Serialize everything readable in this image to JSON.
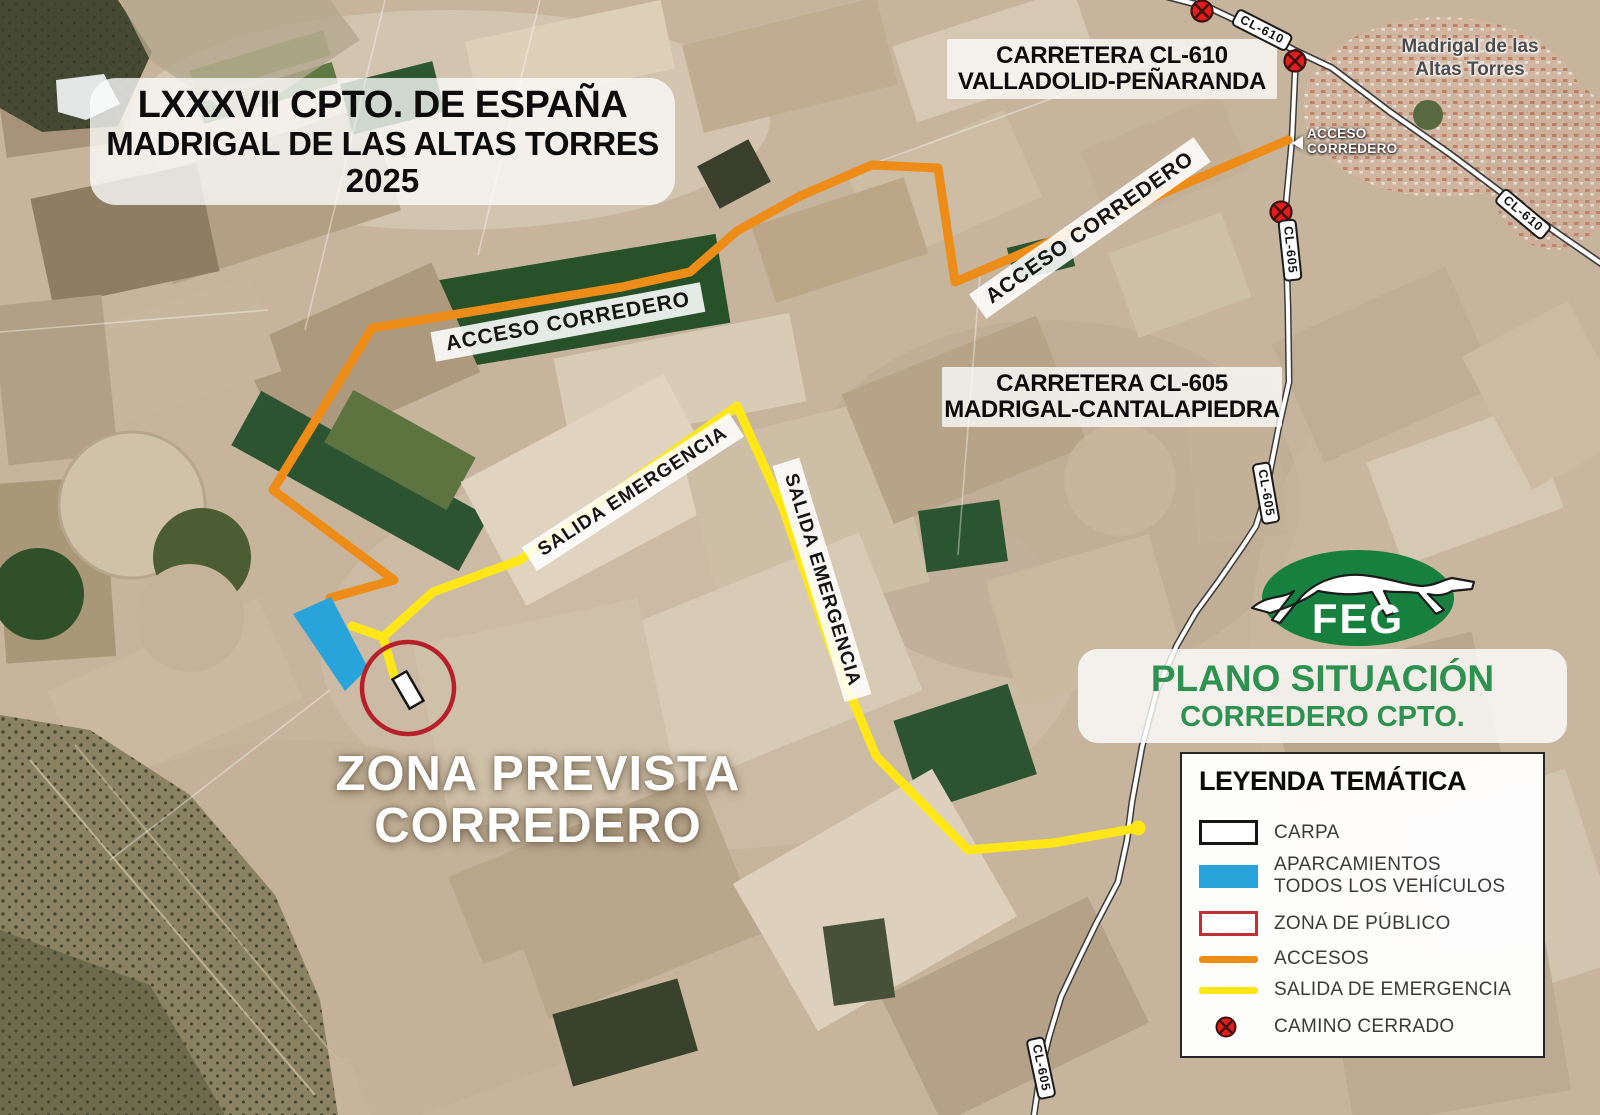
{
  "title_box": {
    "line1": "LXXXVII CPTO. DE ESPAÑA",
    "line2": "MADRIGAL DE LAS ALTAS TORRES",
    "line3": "2025"
  },
  "carretera_cl610": {
    "line1": "CARRETERA  CL-610",
    "line2": "VALLADOLID-PEÑARANDA"
  },
  "carretera_cl605": {
    "line1": "CARRETERA  CL-605",
    "line2": "MADRIGAL-CANTALAPIEDRA"
  },
  "town_label": {
    "line1": "Madrigal de las",
    "line2": "Altas Torres"
  },
  "acceso_junction": {
    "line1": "ACCESO",
    "line2": "CORREDERO"
  },
  "route_labels": {
    "acceso_upper": "ACCESO CORREDERO",
    "acceso_lower": "ACCESO CORREDERO",
    "salida_west": "SALIDA EMERGENCIA",
    "salida_east": "SALIDA EMERGENCIA"
  },
  "road_labels": {
    "cl610_top": "CL-610",
    "cl610_right": "CL-610",
    "cl605_upper": "CL-605",
    "cl605_mid": "CL-605",
    "cl605_lower": "CL-605"
  },
  "zona_label": {
    "line1": "ZONA PREVISTA",
    "line2": "CORREDERO"
  },
  "plano_box": {
    "line1": "PLANO SITUACIÓN",
    "line2": "CORREDERO CPTO."
  },
  "logo": {
    "acronym": "FEG"
  },
  "legend": {
    "title": "LEYENDA TEMÁTICA",
    "items": [
      {
        "label": "CARPA"
      },
      {
        "label": "APARCAMIENTOS",
        "label2": "TODOS LOS VEHÍCULOS"
      },
      {
        "label": "ZONA DE PÚBLICO"
      },
      {
        "label": "ACCESOS"
      },
      {
        "label": "SALIDA DE EMERGENCIA"
      },
      {
        "label": "CAMINO CERRADO"
      }
    ]
  },
  "colors": {
    "acceso_orange": "#ee8c18",
    "salida_yellow": "#ffe617",
    "parking_blue": "#29a4da",
    "publico_red": "#b7202a",
    "camino_red": "#e11d1d",
    "feg_green": "#18803f",
    "plano_green": "#2d9150"
  }
}
